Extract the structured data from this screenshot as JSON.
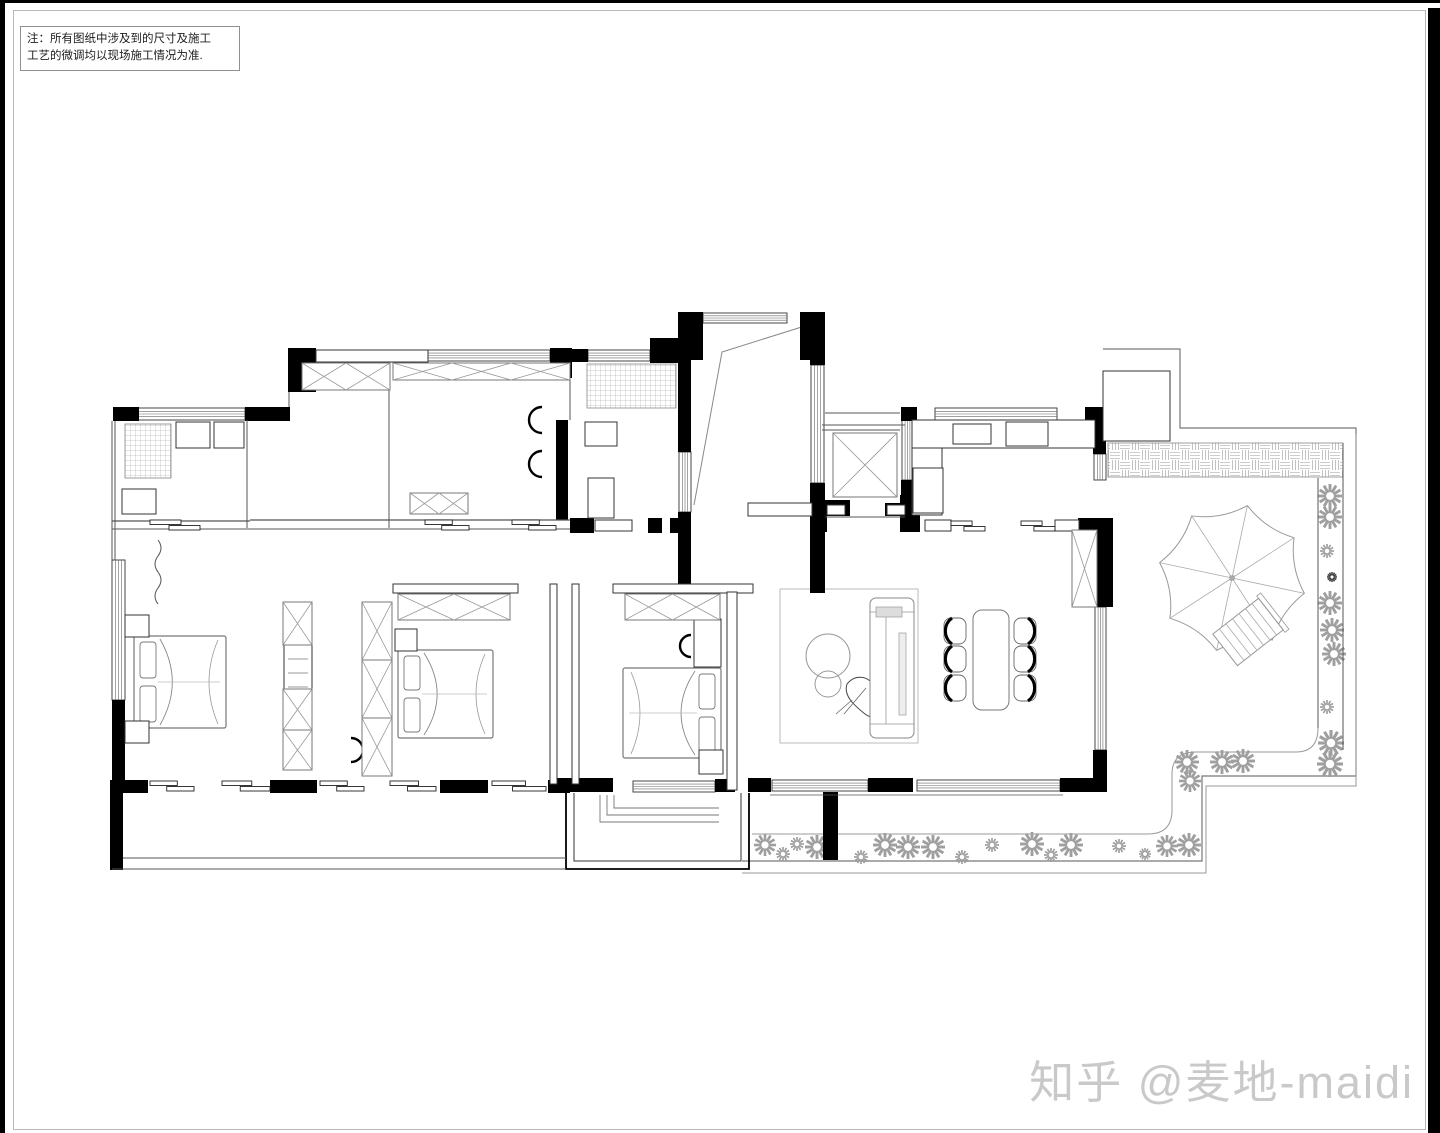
{
  "note": {
    "line1": "注：所有图纸中涉及到的尺寸及施工",
    "line2": "工艺的微调均以现场施工情况为准."
  },
  "watermark": {
    "text": "知乎 @麦地-maidi"
  },
  "colors": {
    "wall": "#000000",
    "thin": "#555555",
    "light": "#999999",
    "flower": "#9f9f9f",
    "watermark": "#c9c9c9",
    "paper": "#ffffff"
  },
  "plan": {
    "walls": [
      [
        113,
        407,
        26,
        14
      ],
      [
        245,
        407,
        45,
        14
      ],
      [
        288,
        348,
        28,
        44
      ],
      [
        550,
        348,
        22,
        30
      ],
      [
        560,
        349,
        28,
        13
      ],
      [
        650,
        338,
        30,
        25
      ],
      [
        678,
        312,
        25,
        48
      ],
      [
        800,
        312,
        25,
        48
      ],
      [
        678,
        360,
        13,
        92
      ],
      [
        678,
        512,
        13,
        73
      ],
      [
        810,
        323,
        15,
        42
      ],
      [
        810,
        483,
        15,
        110
      ],
      [
        670,
        518,
        20,
        15
      ],
      [
        812,
        500,
        15,
        32
      ],
      [
        825,
        500,
        25,
        16
      ],
      [
        885,
        503,
        20,
        13
      ],
      [
        900,
        495,
        20,
        37
      ],
      [
        1078,
        518,
        35,
        30
      ],
      [
        901,
        407,
        16,
        14
      ],
      [
        1085,
        407,
        22,
        14
      ],
      [
        901,
        480,
        13,
        52
      ],
      [
        1093,
        420,
        13,
        34
      ],
      [
        1097,
        545,
        16,
        62
      ],
      [
        1093,
        750,
        14,
        42
      ],
      [
        748,
        778,
        23,
        14
      ],
      [
        868,
        778,
        45,
        14
      ],
      [
        1060,
        778,
        47,
        14
      ],
      [
        556,
        420,
        12,
        100
      ],
      [
        570,
        518,
        24,
        15
      ],
      [
        648,
        518,
        14,
        15
      ],
      [
        112,
        700,
        13,
        92
      ],
      [
        110,
        790,
        13,
        80
      ],
      [
        110,
        780,
        38,
        13
      ],
      [
        270,
        780,
        47,
        13
      ],
      [
        440,
        780,
        48,
        13
      ],
      [
        548,
        780,
        22,
        13
      ],
      [
        557,
        778,
        56,
        14
      ],
      [
        715,
        779,
        20,
        13
      ],
      [
        823,
        792,
        15,
        68
      ],
      [
        191,
        423,
        3,
        9
      ],
      [
        227,
        423,
        3,
        9
      ],
      [
        968,
        424,
        3,
        7
      ]
    ],
    "hrects": [
      [
        316,
        350,
        112,
        12
      ],
      [
        393,
        584,
        125,
        9
      ],
      [
        613,
        584,
        140,
        9
      ],
      [
        550,
        584,
        7,
        200
      ],
      [
        572,
        584,
        7,
        200
      ],
      [
        727,
        592,
        10,
        198
      ],
      [
        925,
        520,
        26,
        11
      ],
      [
        1055,
        520,
        24,
        11
      ],
      [
        748,
        503,
        64,
        13
      ],
      [
        827,
        505,
        18,
        10
      ],
      [
        887,
        505,
        18,
        10
      ],
      [
        595,
        520,
        37,
        11
      ],
      [
        1103,
        371,
        67,
        70
      ],
      [
        912,
        420,
        183,
        28
      ],
      [
        912,
        448,
        30,
        67
      ],
      [
        913,
        468,
        30,
        45
      ],
      [
        953,
        424,
        38,
        20
      ],
      [
        1006,
        422,
        42,
        24
      ],
      [
        585,
        422,
        32,
        24
      ],
      [
        588,
        478,
        26,
        40
      ],
      [
        176,
        422,
        34,
        26
      ],
      [
        214,
        422,
        30,
        26
      ],
      [
        122,
        489,
        34,
        25
      ],
      [
        125,
        615,
        24,
        22
      ],
      [
        125,
        721,
        24,
        22
      ],
      [
        395,
        629,
        22,
        22
      ],
      [
        699,
        750,
        24,
        24
      ],
      [
        694,
        619,
        27,
        48
      ],
      [
        284,
        645,
        28,
        44
      ]
    ],
    "wins": [
      [
        137,
        408,
        108,
        12,
        "h"
      ],
      [
        428,
        350,
        122,
        11,
        "h"
      ],
      [
        588,
        350,
        62,
        11,
        "h"
      ],
      [
        703,
        313,
        84,
        10,
        "h"
      ],
      [
        935,
        408,
        122,
        12,
        "h"
      ],
      [
        772,
        780,
        96,
        11,
        "h"
      ],
      [
        917,
        780,
        143,
        11,
        "h"
      ],
      [
        633,
        781,
        82,
        11,
        "h"
      ],
      [
        811,
        365,
        13,
        118,
        "v"
      ],
      [
        679,
        452,
        12,
        60,
        "v"
      ],
      [
        902,
        420,
        11,
        60,
        "v"
      ],
      [
        1094,
        454,
        12,
        26,
        "v"
      ],
      [
        1095,
        607,
        11,
        143,
        "v"
      ],
      [
        112,
        560,
        13,
        140,
        "v"
      ]
    ],
    "xboxes": [
      [
        302,
        363,
        88,
        27,
        2
      ],
      [
        393,
        363,
        177,
        17,
        3
      ],
      [
        398,
        594,
        112,
        26,
        2
      ],
      [
        625,
        594,
        95,
        26,
        2
      ],
      [
        283,
        602,
        29,
        43,
        1
      ],
      [
        283,
        689,
        29,
        41,
        1
      ],
      [
        283,
        730,
        29,
        40,
        1
      ],
      [
        362,
        602,
        30,
        58,
        1
      ],
      [
        362,
        660,
        30,
        58,
        1
      ],
      [
        362,
        718,
        30,
        58,
        1
      ],
      [
        833,
        433,
        64,
        64,
        1
      ],
      [
        1072,
        530,
        25,
        77,
        1
      ],
      [
        410,
        493,
        58,
        21,
        2
      ]
    ],
    "hatches": [
      {
        "r": [
          125,
          424,
          46,
          54
        ],
        "p": "grid"
      },
      {
        "r": [
          587,
          364,
          89,
          44
        ],
        "p": "grid"
      },
      {
        "r": [
          1108,
          443,
          235,
          34
        ],
        "p": "weave"
      }
    ],
    "lines": [
      [
        247,
        420,
        247,
        528,
        1
      ],
      [
        389,
        362,
        389,
        528,
        1
      ],
      [
        112,
        421,
        112,
        560,
        1
      ],
      [
        115,
        421,
        115,
        560,
        1
      ],
      [
        822,
        425,
        905,
        425,
        1
      ],
      [
        822,
        430,
        900,
        430,
        1
      ],
      [
        825,
        517,
        905,
        517,
        1
      ],
      [
        250,
        520,
        570,
        520,
        1.2
      ],
      [
        250,
        529,
        570,
        529,
        1
      ],
      [
        112,
        521,
        250,
        521,
        1.2
      ],
      [
        112,
        529,
        250,
        529,
        1
      ],
      [
        289,
        392,
        289,
        407,
        1
      ],
      [
        570,
        362,
        570,
        420,
        1
      ],
      [
        825,
        413,
        900,
        413,
        1
      ],
      [
        770,
        795,
        1063,
        795,
        0.8
      ],
      [
        123,
        858,
        566,
        858,
        1
      ],
      [
        112,
        869,
        566,
        869,
        1
      ],
      [
        1343,
        443,
        1343,
        750,
        1
      ],
      [
        1318,
        478,
        1318,
        728,
        1
      ]
    ],
    "paths": [
      {
        "d": "M808,325 L722,352 L694,505",
        "w": 1,
        "c": "#888888"
      },
      {
        "d": "M1103,349 H1180 V428 H1356 V776 H1202 V861 H742",
        "w": 1.2,
        "c": "#777777"
      },
      {
        "d": "M1356,434 V786 H1206 V873 H742",
        "w": 1,
        "c": "#999999"
      },
      {
        "d": "M752,834 H1148 Q1172,834 1172,810 V774 Q1172,752 1196,752 H1296 Q1318,752 1318,728",
        "w": 1,
        "c": "#999999"
      },
      {
        "d": "M158,540 q6,8 0,16 q-6,8 0,16 q6,8 0,16 q-6,8 0,16",
        "w": 1,
        "c": "#555555"
      },
      {
        "d": "M566,793 V869 H749 V793",
        "w": 1.8,
        "c": "#000000"
      },
      {
        "d": "M574,793 V861 H741 V793",
        "w": 1,
        "c": "#333333"
      },
      {
        "d": "M600,795 V822 H719",
        "w": 0.9,
        "c": "#777777"
      },
      {
        "d": "M607,795 V815 H719",
        "w": 0.9,
        "c": "#777777"
      },
      {
        "d": "M614,795 V808 H719",
        "w": 0.9,
        "c": "#777777"
      },
      {
        "d": "M847,684 c8,-10 20,-8 26,0 c8,10 16,14 14,24 c-2,10 -14,12 -22,6 c-10,-8 -22,-18 -18,-30 z",
        "w": 1,
        "c": "#444444"
      },
      {
        "d": "M852,700 l-16,14 M866,688 l-22,26",
        "w": 0.8,
        "c": "#666666"
      },
      {
        "d": "M1128,390 q6,12 0,24 M1144,388 q-6,12 4,22 M1122,404 q12,2 20,14 M1136,384 q2,10 10,8",
        "w": 2.2,
        "c": "#111111"
      }
    ],
    "slides": [
      [
        150,
        781,
        44
      ],
      [
        222,
        781,
        48
      ],
      [
        320,
        781,
        44
      ],
      [
        390,
        781,
        46
      ],
      [
        492,
        781,
        54
      ],
      [
        951,
        521,
        34
      ],
      [
        1021,
        521,
        34
      ],
      [
        425,
        520,
        44
      ],
      [
        512,
        520,
        44
      ],
      [
        150,
        520,
        50
      ]
    ],
    "flowers": [
      [
        1330,
        496,
        12
      ],
      [
        1330,
        517,
        12
      ],
      [
        1327,
        551,
        7
      ],
      [
        1332,
        577,
        5,
        "#444444"
      ],
      [
        1330,
        603,
        12
      ],
      [
        1332,
        630,
        12
      ],
      [
        1334,
        654,
        12
      ],
      [
        1327,
        707,
        7
      ],
      [
        1331,
        743,
        13
      ],
      [
        1330,
        764,
        13
      ],
      [
        1187,
        762,
        12
      ],
      [
        1190,
        781,
        11
      ],
      [
        1222,
        762,
        12
      ],
      [
        1243,
        761,
        12
      ],
      [
        765,
        845,
        11
      ],
      [
        783,
        854,
        7
      ],
      [
        797,
        844,
        7
      ],
      [
        817,
        847,
        12
      ],
      [
        861,
        857,
        7
      ],
      [
        885,
        845,
        12
      ],
      [
        908,
        847,
        12
      ],
      [
        933,
        847,
        12
      ],
      [
        962,
        857,
        7
      ],
      [
        992,
        845,
        7
      ],
      [
        1032,
        844,
        12
      ],
      [
        1051,
        855,
        7
      ],
      [
        1071,
        845,
        12
      ],
      [
        1119,
        846,
        7
      ],
      [
        1145,
        854,
        6
      ],
      [
        1167,
        846,
        11
      ],
      [
        1189,
        845,
        12
      ]
    ],
    "beds": [
      {
        "r": [
          134,
          636,
          92,
          92
        ],
        "head": "W"
      },
      {
        "r": [
          398,
          650,
          95,
          88
        ],
        "head": "W"
      },
      {
        "r": [
          623,
          668,
          98,
          90
        ],
        "head": "E"
      }
    ],
    "nstands": [
      [
        125,
        615
      ],
      [
        125,
        721
      ],
      [
        395,
        629
      ],
      [
        701,
        752
      ]
    ],
    "chairc": [
      {
        "c": [
          538,
          420
        ],
        "r": 13,
        "rot": 0
      },
      {
        "c": [
          538,
          464
        ],
        "r": 13,
        "rot": 0
      },
      {
        "c": [
          687,
          646
        ],
        "r": 11,
        "rot": 0
      },
      {
        "c": [
          355,
          750
        ],
        "r": 12,
        "rot": 180
      }
    ],
    "circles": [
      {
        "c": [
          828,
          656
        ],
        "r": 22,
        "w": 1,
        "s": "#999999"
      },
      {
        "c": [
          828,
          684
        ],
        "r": 13,
        "w": 1,
        "s": "#999999"
      },
      {
        "c": [
          1017,
          434
        ],
        "r": 7,
        "w": 1.2,
        "s": "#555555"
      },
      {
        "c": [
          1037,
          434
        ],
        "r": 7,
        "w": 1.2,
        "s": "#555555"
      },
      {
        "c": [
          600,
          498
        ],
        "r": 1.6,
        "w": 1,
        "s": "#333333",
        "f": "#333333"
      },
      {
        "c": [
          970,
          434
        ],
        "r": 1.6,
        "w": 1,
        "s": "#333333",
        "f": "#333333"
      },
      {
        "c": [
          193,
          432
        ],
        "r": 1.4,
        "w": 1,
        "s": "#333333",
        "f": "#333333"
      },
      {
        "c": [
          229,
          432
        ],
        "r": 1.4,
        "w": 1,
        "s": "#333333",
        "f": "#333333"
      }
    ],
    "rug": [
      780,
      589,
      138,
      154
    ],
    "sofa": {
      "outer": [
        870,
        598,
        44,
        140
      ],
      "pillow": [
        876,
        607,
        26,
        10
      ],
      "console": [
        899,
        633,
        7,
        82
      ]
    },
    "dining": {
      "table": [
        973,
        610,
        36,
        100
      ],
      "lx": 955,
      "rx": 1025,
      "rows": [
        631,
        659,
        688
      ],
      "cw": 22,
      "ch": 26
    },
    "umbrella": {
      "c": [
        1232,
        578
      ],
      "R": 74,
      "rot": 12
    },
    "lounge": {
      "c": [
        1248,
        632
      ],
      "w": 58,
      "h": 40,
      "rot": -38,
      "stripes": 7
    },
    "tree": {
      "c": [
        1136,
        405
      ],
      "r": 27
    }
  }
}
